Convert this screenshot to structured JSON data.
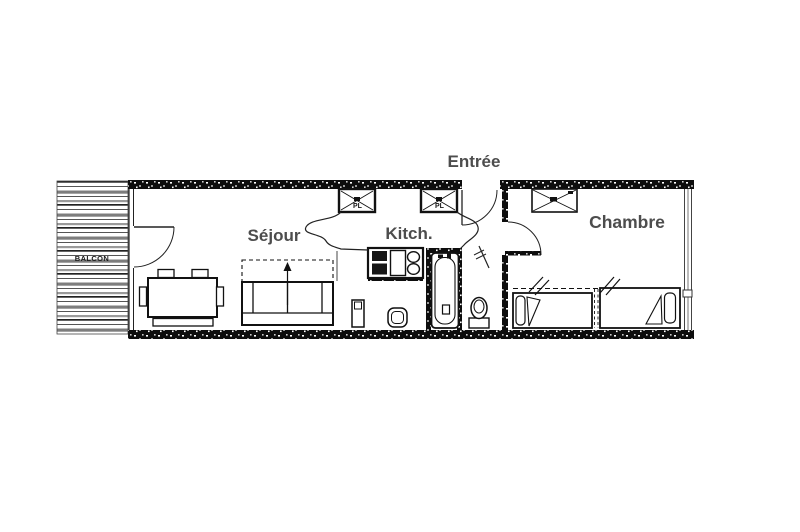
{
  "plan": {
    "type": "apartment-floor-plan",
    "labels": {
      "entree": "Entrée",
      "sejour": "Séjour",
      "kitchen": "Kitch.",
      "chambre": "Chambre",
      "balcon": "BALCON",
      "closet_left": "PL",
      "closet_right": "PL"
    },
    "colors": {
      "background": "#ffffff",
      "wall_fill": "#0d0d0d",
      "line": "#1a1a1a",
      "room_label": "#4d4d4d",
      "balcony_stripe_gray": "#7d7d7d"
    },
    "icons": {
      "balcony": "striped-deck",
      "closets": "crossed-box",
      "doors": "quarter-circle-arc",
      "sofa_bed": "rect-with-unfold-arrow",
      "dining_table": "rect-with-chairs",
      "beds": "twin-beds-with-pillows",
      "bathtub": "oval-tub",
      "toilet": "wc-bowl",
      "kitchen_unit": "hob-and-double-sink"
    }
  }
}
